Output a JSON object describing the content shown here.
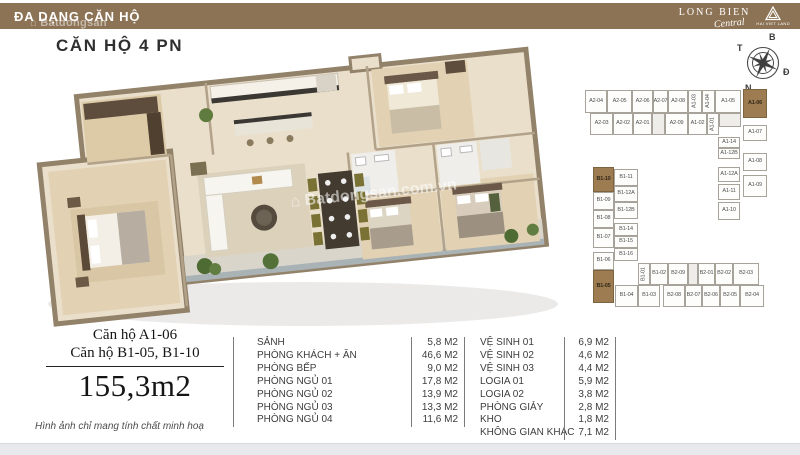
{
  "header": {
    "bar_title": "ĐA DẠNG CĂN HỘ",
    "brand_name": "LONG BIEN",
    "brand_script": "Central",
    "brand_tagline": "HAI VIET LAND"
  },
  "watermark": {
    "header_text": "⌂ Batdongsan",
    "plan_text": "⌂ Batdongsan.com.vn"
  },
  "page": {
    "title": "CĂN HỘ 4 PN"
  },
  "compass": {
    "n": "B",
    "s": "N",
    "w": "T",
    "e": "Đ"
  },
  "unit_info": {
    "line1": "Căn hộ A1-06",
    "line2": "Căn hộ B1-05, B1-10",
    "total_area": "155,3m2",
    "disclaimer": "Hình ảnh chỉ mang tính chất minh hoạ"
  },
  "room_table_left": [
    {
      "name": "SẢNH",
      "area": "5,8 M2"
    },
    {
      "name": "PHÒNG KHÁCH + ĂN",
      "area": "46,6 M2"
    },
    {
      "name": "PHÒNG BẾP",
      "area": "9,0 M2"
    },
    {
      "name": "PHÒNG NGỦ 01",
      "area": "17,8 M2"
    },
    {
      "name": "PHÒNG NGỦ 02",
      "area": "13,9 M2"
    },
    {
      "name": "PHÒNG NGỦ 03",
      "area": "13,3 M2"
    },
    {
      "name": "PHÒNG NGỦ 04",
      "area": "11,6 M2"
    }
  ],
  "room_table_right": [
    {
      "name": "VỆ SINH 01",
      "area": "6,9 M2"
    },
    {
      "name": "VỆ SINH 02",
      "area": "4,6 M2"
    },
    {
      "name": "VỆ SINH 03",
      "area": "4,4 M2"
    },
    {
      "name": "LOGIA 01",
      "area": "5,9 M2"
    },
    {
      "name": "LOGIA 02",
      "area": "3,8 M2"
    },
    {
      "name": "PHÒNG GIẢY",
      "area": "2,8 M2"
    },
    {
      "name": "KHO",
      "area": "1,8 M2"
    },
    {
      "name": "KHÔNG GIAN KHÁC",
      "area": "7,1 M2"
    }
  ],
  "unit_map": {
    "highlighted_units": [
      "A1-06",
      "B1-10",
      "B1-05"
    ],
    "units": [
      {
        "l": "A2-04",
        "x": 23,
        "y": 5,
        "w": 22,
        "h": 23
      },
      {
        "l": "A2-05",
        "x": 45,
        "y": 5,
        "w": 25,
        "h": 23
      },
      {
        "l": "A2-06",
        "x": 70,
        "y": 5,
        "w": 21,
        "h": 23
      },
      {
        "l": "A2-07",
        "x": 91,
        "y": 5,
        "w": 15,
        "h": 23
      },
      {
        "l": "A2-08",
        "x": 106,
        "y": 5,
        "w": 20,
        "h": 23
      },
      {
        "l": "A1-03",
        "x": 126,
        "y": 5,
        "w": 14,
        "h": 23,
        "v": true
      },
      {
        "l": "A1-04",
        "x": 140,
        "y": 5,
        "w": 13,
        "h": 23,
        "v": true
      },
      {
        "l": "A1-05",
        "x": 153,
        "y": 5,
        "w": 26,
        "h": 23
      },
      {
        "l": "A1-06",
        "x": 181,
        "y": 4,
        "w": 24,
        "h": 29,
        "hl": true
      },
      {
        "l": "A2-03",
        "x": 28,
        "y": 28,
        "w": 23,
        "h": 22
      },
      {
        "l": "A2-02",
        "x": 51,
        "y": 28,
        "w": 20,
        "h": 22
      },
      {
        "l": "A2-01",
        "x": 71,
        "y": 28,
        "w": 19,
        "h": 22
      },
      {
        "l": "",
        "x": 90,
        "y": 28,
        "w": 13,
        "h": 22,
        "core": true
      },
      {
        "l": "A2-09",
        "x": 103,
        "y": 28,
        "w": 23,
        "h": 22
      },
      {
        "l": "A1-02",
        "x": 126,
        "y": 28,
        "w": 19,
        "h": 22
      },
      {
        "l": "A1-01",
        "x": 145,
        "y": 28,
        "w": 12,
        "h": 22,
        "v": true
      },
      {
        "l": "",
        "x": 157,
        "y": 28,
        "w": 22,
        "h": 14,
        "core": true
      },
      {
        "l": "A1-07",
        "x": 181,
        "y": 40,
        "w": 24,
        "h": 16
      },
      {
        "l": "A1-14",
        "x": 156,
        "y": 52,
        "w": 22,
        "h": 11
      },
      {
        "l": "A1-12B",
        "x": 156,
        "y": 63,
        "w": 22,
        "h": 11
      },
      {
        "l": "A1-08",
        "x": 181,
        "y": 68,
        "w": 24,
        "h": 18
      },
      {
        "l": "A1-12A",
        "x": 156,
        "y": 82,
        "w": 22,
        "h": 15
      },
      {
        "l": "A1-09",
        "x": 181,
        "y": 90,
        "w": 24,
        "h": 22
      },
      {
        "l": "A1-11",
        "x": 156,
        "y": 99,
        "w": 22,
        "h": 16
      },
      {
        "l": "A1-10",
        "x": 156,
        "y": 117,
        "w": 22,
        "h": 18
      },
      {
        "l": "B1-10",
        "x": 31,
        "y": 82,
        "w": 21,
        "h": 25,
        "hl": true
      },
      {
        "l": "B1-11",
        "x": 52,
        "y": 84,
        "w": 24,
        "h": 17
      },
      {
        "l": "B1-09",
        "x": 31,
        "y": 107,
        "w": 21,
        "h": 18
      },
      {
        "l": "B1-12A",
        "x": 52,
        "y": 101,
        "w": 24,
        "h": 16
      },
      {
        "l": "B1-08",
        "x": 31,
        "y": 125,
        "w": 21,
        "h": 18
      },
      {
        "l": "B1-12B",
        "x": 52,
        "y": 117,
        "w": 24,
        "h": 17
      },
      {
        "l": "B1-07",
        "x": 31,
        "y": 143,
        "w": 21,
        "h": 20
      },
      {
        "l": "B1-14",
        "x": 52,
        "y": 138,
        "w": 24,
        "h": 13
      },
      {
        "l": "B1-15",
        "x": 52,
        "y": 151,
        "w": 24,
        "h": 12
      },
      {
        "l": "B1-06",
        "x": 31,
        "y": 167,
        "w": 21,
        "h": 18
      },
      {
        "l": "B1-16",
        "x": 52,
        "y": 163,
        "w": 24,
        "h": 13
      },
      {
        "l": "B1-05",
        "x": 31,
        "y": 185,
        "w": 21,
        "h": 33,
        "hl": true
      },
      {
        "l": "B1-01",
        "x": 76,
        "y": 178,
        "w": 12,
        "h": 22,
        "v": true
      },
      {
        "l": "B1-02",
        "x": 88,
        "y": 178,
        "w": 18,
        "h": 22
      },
      {
        "l": "B2-09",
        "x": 106,
        "y": 178,
        "w": 20,
        "h": 22
      },
      {
        "l": "",
        "x": 126,
        "y": 178,
        "w": 10,
        "h": 22,
        "core": true
      },
      {
        "l": "B2-01",
        "x": 136,
        "y": 178,
        "w": 17,
        "h": 22
      },
      {
        "l": "B2-02",
        "x": 153,
        "y": 178,
        "w": 18,
        "h": 22
      },
      {
        "l": "B2-03",
        "x": 171,
        "y": 178,
        "w": 26,
        "h": 22
      },
      {
        "l": "B1-04",
        "x": 53,
        "y": 200,
        "w": 23,
        "h": 22
      },
      {
        "l": "B1-03",
        "x": 76,
        "y": 200,
        "w": 22,
        "h": 22
      },
      {
        "l": "B2-08",
        "x": 101,
        "y": 200,
        "w": 22,
        "h": 22
      },
      {
        "l": "B2-07",
        "x": 123,
        "y": 200,
        "w": 17,
        "h": 22
      },
      {
        "l": "B2-06",
        "x": 140,
        "y": 200,
        "w": 18,
        "h": 22
      },
      {
        "l": "B2-05",
        "x": 158,
        "y": 200,
        "w": 20,
        "h": 22
      },
      {
        "l": "B2-04",
        "x": 178,
        "y": 200,
        "w": 24,
        "h": 22
      }
    ]
  },
  "colors": {
    "header_brown": "#8d7355",
    "unit_highlight": "#9c7c50"
  }
}
